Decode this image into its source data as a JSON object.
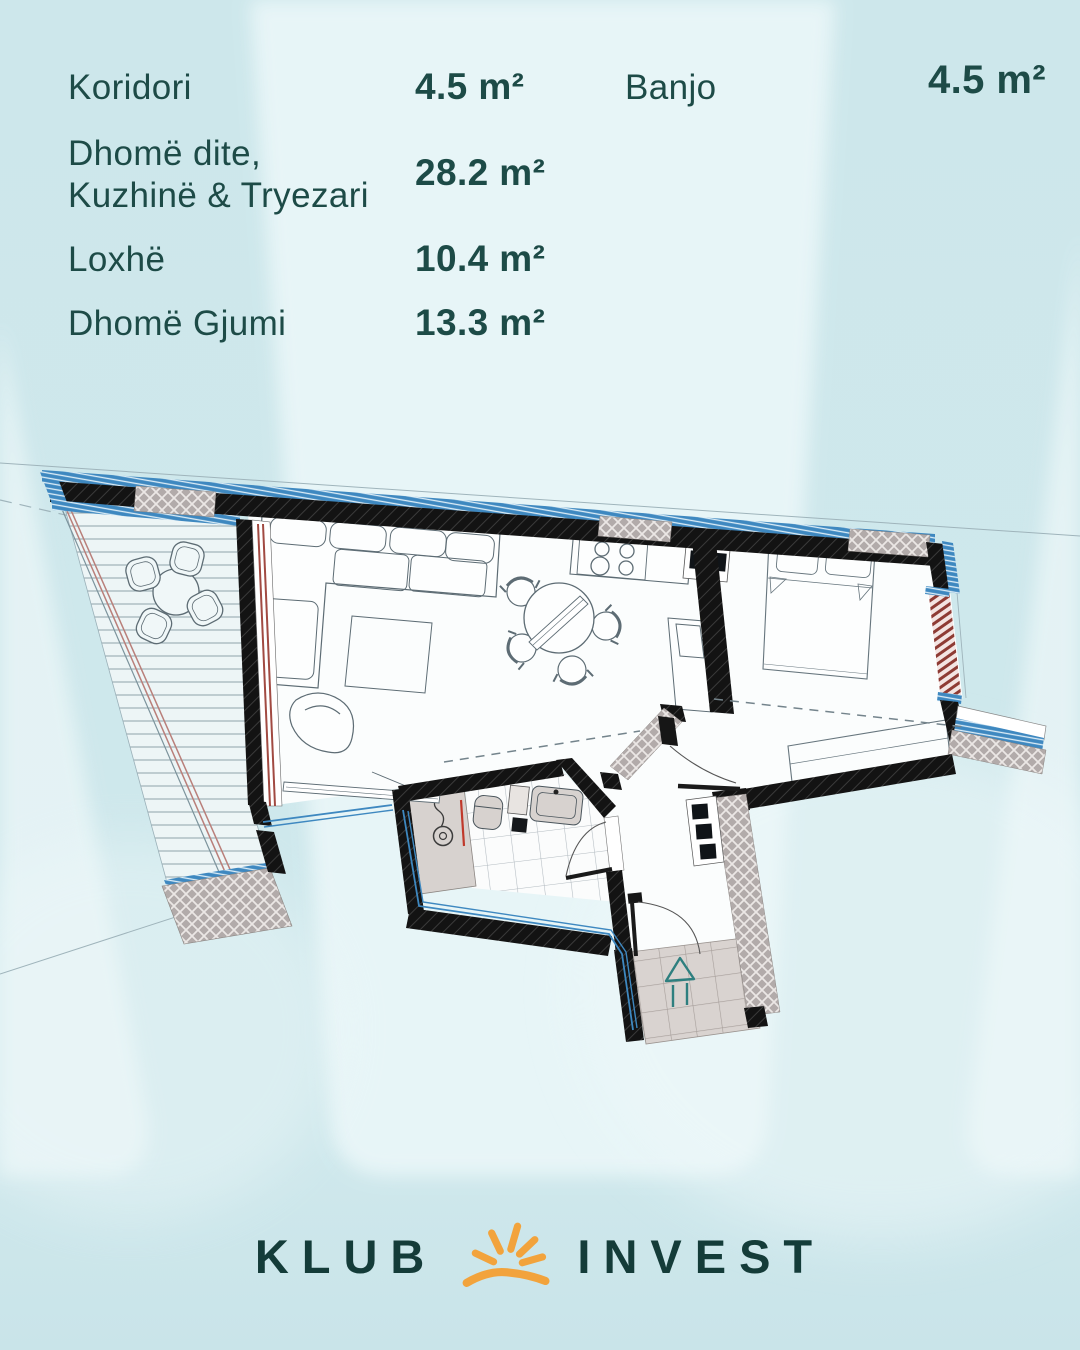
{
  "legend": {
    "rows": [
      {
        "label": "Koridori",
        "area": "4.5 m²"
      },
      {
        "label": "Dhomë dite,",
        "label2": "Kuzhinë & Tryezari",
        "area": "28.2 m²"
      },
      {
        "label": "Loxhë",
        "area": "10.4 m²"
      },
      {
        "label": "Dhomë Gjumi",
        "area": "13.3 m²"
      }
    ],
    "right_column": {
      "label": "Banjo",
      "area": "4.5 m²"
    }
  },
  "logo": {
    "brand_left": "KLUB",
    "brand_right": "INVEST"
  },
  "colors": {
    "text": "#1d4b47",
    "background": "#cfe8ec",
    "light_beam": "#e9f6f8",
    "logo_text": "#143c39",
    "sun_orange": "#f2a33c",
    "wall_black": "#141414",
    "insulation_blue": "#3e88c0",
    "window_red": "#8e3b34",
    "entry_arrow": "#2e7f7f"
  }
}
